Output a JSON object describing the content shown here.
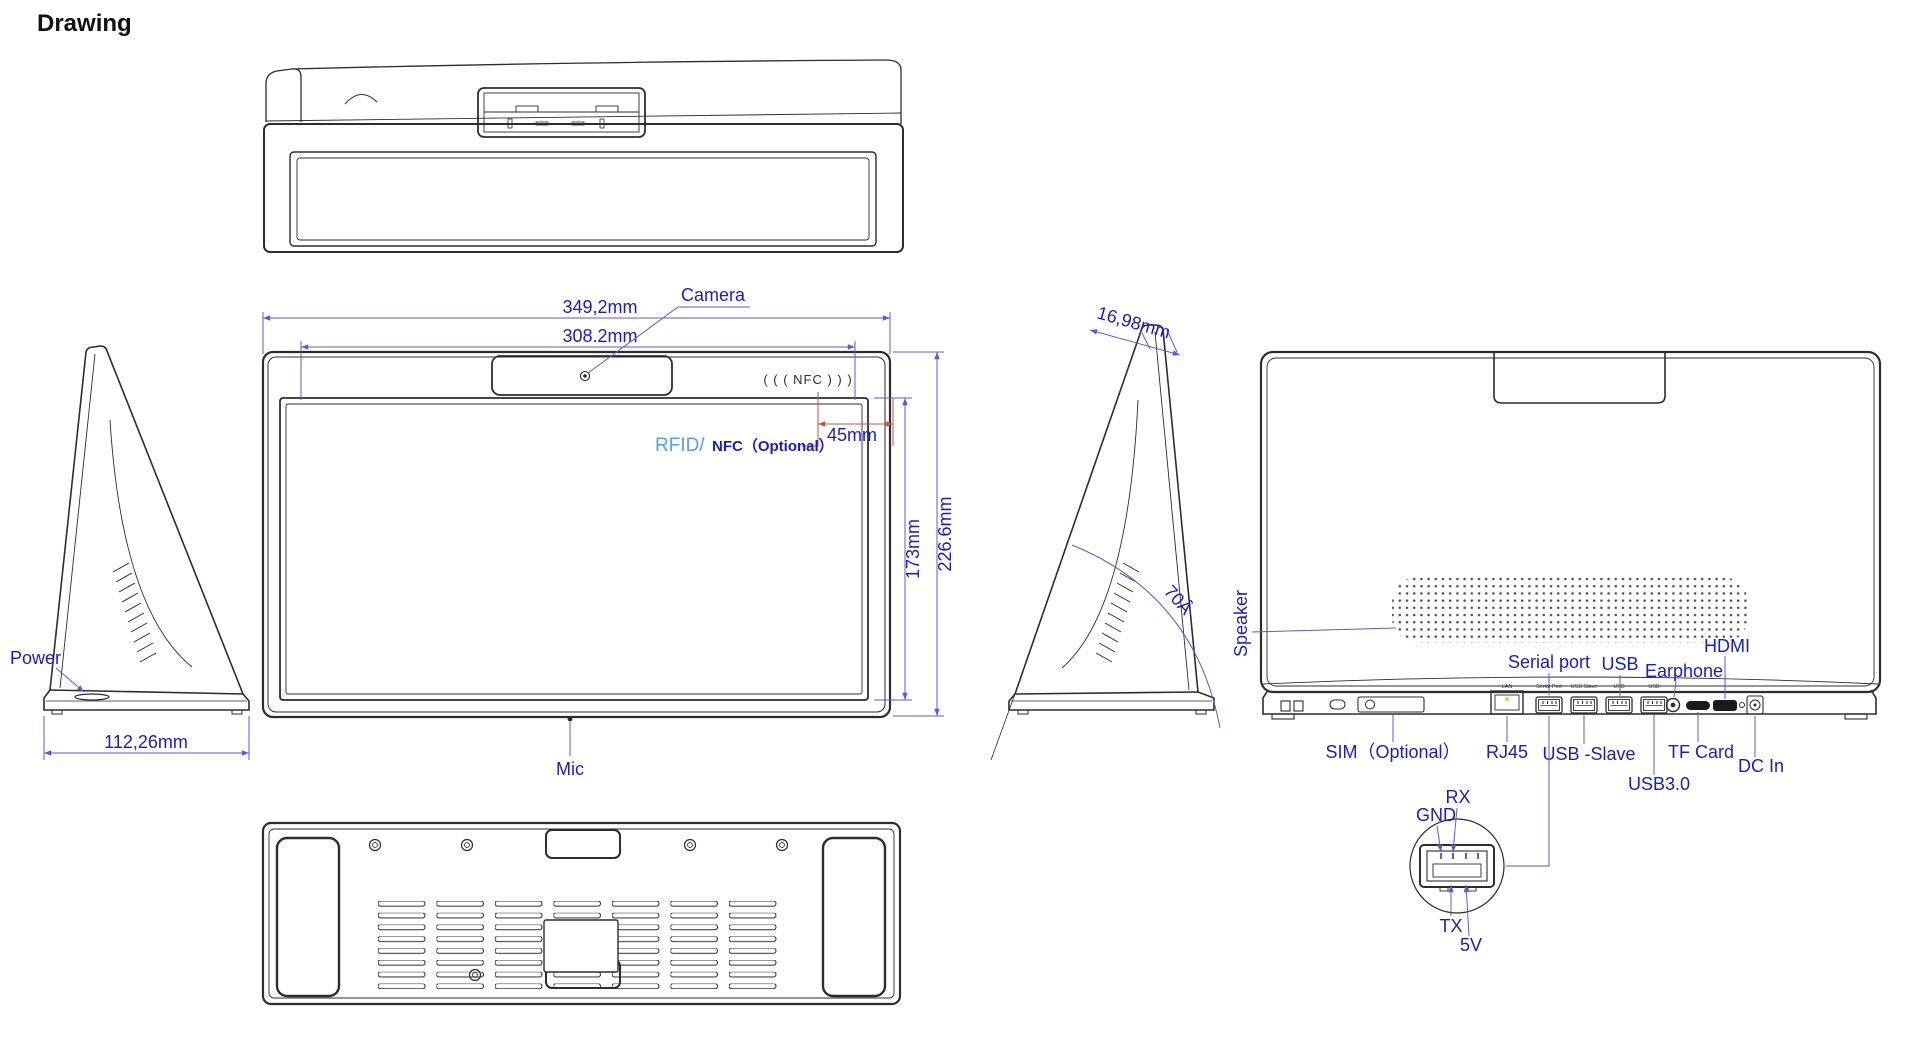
{
  "title": "Drawing",
  "colors": {
    "line": "#2d2d2d",
    "dim_line_blue": "#5b5bd8",
    "label_blue": "#1b1bcb",
    "rfid_light_blue": "#55a0e8",
    "leader_red": "#c4504e"
  },
  "front": {
    "dim_outer_width": "349,2mm",
    "dim_screen_width": "308.2mm",
    "dim_nfc_offset": "45mm",
    "dim_screen_height": "173mm",
    "dim_outer_height": "226.6mm",
    "camera": "Camera",
    "mic": "Mic",
    "rfid": "RFID/",
    "rfid_optional": "NFC（Optional）",
    "nfc_mark": "( ( (  NFC  ) ) )"
  },
  "left_side": {
    "power": "Power",
    "dim_base_depth": "112,26mm"
  },
  "right_side": {
    "dim_thickness": "16,98mm",
    "dim_angle": "70Â"
  },
  "back": {
    "speaker": "Speaker",
    "serial_port": "Serial port",
    "usb": "USB",
    "earphone": "Earphone",
    "hdmi": "HDMI",
    "sim": "SIM（Optional）",
    "rj45": "RJ45",
    "usb_slave": "USB -Slave",
    "usb30": "USB3.0",
    "tf_card": "TF Card",
    "dc_in": "DC In",
    "printed": {
      "lan": "LAN",
      "serial": "Serial Port",
      "usb_slave": "USB Slave",
      "usb1": "USB",
      "usb2": "USB"
    }
  },
  "detail": {
    "rx": "RX",
    "gnd": "GND",
    "tx": "TX",
    "v5": "5V"
  }
}
